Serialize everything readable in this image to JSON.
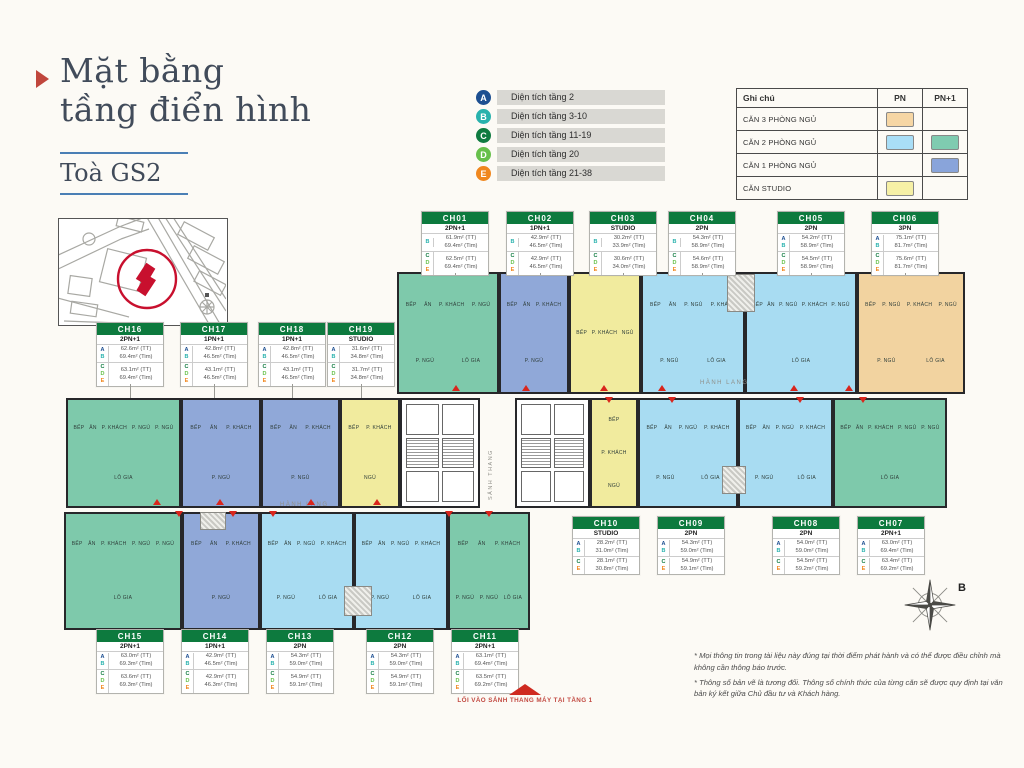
{
  "page": {
    "title_line1": "Mặt bằng",
    "title_line2": "tầng điển hình",
    "tower": "Toà GS2",
    "compass_letter": "B",
    "entry_label": "LỐI VÀO SẢNH THANG MÁY TẠI TẦNG 1"
  },
  "footnotes": [
    "* Mọi thông tin trong tài liệu này đúng tại thời điểm phát hành và có thể được điều chỉnh mà không cần thông báo trước.",
    "* Thông số bản vẽ là tương đối. Thông số chính thức của từng căn sẽ được quy định tại văn bản ký kết giữa Chủ đầu tư và Khách hàng."
  ],
  "legend_floors": [
    {
      "letter": "A",
      "color": "#1d4f91",
      "label": "Diện tích tầng 2"
    },
    {
      "letter": "B",
      "color": "#29b2ad",
      "label": "Diện tích tầng 3-10"
    },
    {
      "letter": "C",
      "color": "#0f7b40",
      "label": "Diện tích tầng 11-19"
    },
    {
      "letter": "D",
      "color": "#67c04b",
      "label": "Diện tích tầng 20"
    },
    {
      "letter": "E",
      "color": "#f0871e",
      "label": "Diện tích tầng 21-38"
    }
  ],
  "legend_table": {
    "header": [
      "Ghi chú",
      "PN",
      "PN+1"
    ],
    "rows": [
      {
        "label": "CĂN 3 PHÒNG NGỦ",
        "pn": "#f6d6a4",
        "pn1": null
      },
      {
        "label": "CĂN 2 PHÒNG NGỦ",
        "pn": "#a9def7",
        "pn1": "#7fcbb0"
      },
      {
        "label": "CĂN 1 PHÒNG NGỦ",
        "pn": null,
        "pn1": "#89a4da"
      },
      {
        "label": "CĂN STUDIO",
        "pn": "#f6f0a6",
        "pn1": null
      }
    ]
  },
  "letter_colors": {
    "A": "#1d4f91",
    "B": "#29b2ad",
    "C": "#0f7b40",
    "D": "#67c04b",
    "E": "#f0871e"
  },
  "type_colors": {
    "2PN+1": "#7ec9ab",
    "1PN+1": "#90a8d8",
    "STUDIO": "#f1eb9e",
    "2PN": "#a8dcf2",
    "3PN": "#f2d3a0"
  },
  "room_labels_by_type": {
    "STUDIO": [
      "BẾP",
      "P. KHÁCH",
      "NGỦ"
    ],
    "1PN+1": [
      "BẾP",
      "ĂN",
      "P. KHÁCH",
      "P. NGỦ"
    ],
    "2PN": [
      "BẾP",
      "ĂN",
      "P. NGỦ",
      "P. KHÁCH",
      "P. NGỦ",
      "LÔ GIA"
    ],
    "2PN+1": [
      "BẾP",
      "ĂN",
      "P. KHÁCH",
      "P. NGỦ",
      "P. NGỦ",
      "LÔ GIA"
    ],
    "3PN": [
      "BẾP",
      "P. NGỦ",
      "P. KHÁCH",
      "P. NGỦ",
      "P. NGỦ",
      "LÔ GIA"
    ]
  },
  "units": [
    {
      "id": "CH01",
      "type": "2PN+1",
      "card": {
        "row": "r1",
        "x": 421
      },
      "plan": {
        "wing": "top",
        "x": 397,
        "w": 102
      },
      "groups": [
        {
          "letters": [
            "B"
          ],
          "tt": "61.9m² (TT)",
          "tim": "69.4m² (Tim)"
        },
        {
          "letters": [
            "C",
            "D",
            "E"
          ],
          "tt": "62.5m² (TT)",
          "tim": "69.4m² (Tim)"
        }
      ]
    },
    {
      "id": "CH02",
      "type": "1PN+1",
      "card": {
        "row": "r1",
        "x": 506
      },
      "plan": {
        "wing": "top",
        "x": 499,
        "w": 70
      },
      "groups": [
        {
          "letters": [
            "B"
          ],
          "tt": "42.9m² (TT)",
          "tim": "46.5m² (Tim)"
        },
        {
          "letters": [
            "C",
            "D",
            "E"
          ],
          "tt": "42.9m² (TT)",
          "tim": "46.5m² (Tim)"
        }
      ]
    },
    {
      "id": "CH03",
      "type": "STUDIO",
      "card": {
        "row": "r1",
        "x": 589
      },
      "plan": {
        "wing": "top",
        "x": 569,
        "w": 72
      },
      "groups": [
        {
          "letters": [
            "B"
          ],
          "tt": "30.2m² (TT)",
          "tim": "33.9m² (Tim)"
        },
        {
          "letters": [
            "C",
            "D",
            "E"
          ],
          "tt": "30.6m² (TT)",
          "tim": "34.0m² (Tim)"
        }
      ]
    },
    {
      "id": "CH04",
      "type": "2PN",
      "card": {
        "row": "r1",
        "x": 668
      },
      "plan": {
        "wing": "top",
        "x": 641,
        "w": 104
      },
      "groups": [
        {
          "letters": [
            "B"
          ],
          "tt": "54.3m² (TT)",
          "tim": "58.9m² (Tim)"
        },
        {
          "letters": [
            "C",
            "D",
            "E"
          ],
          "tt": "54.6m² (TT)",
          "tim": "58.9m² (Tim)"
        }
      ]
    },
    {
      "id": "CH05",
      "type": "2PN",
      "card": {
        "row": "r1",
        "x": 777
      },
      "plan": {
        "wing": "top",
        "x": 745,
        "w": 112
      },
      "groups": [
        {
          "letters": [
            "A",
            "B"
          ],
          "tt": "54.2m² (TT)",
          "tim": "58.9m² (Tim)"
        },
        {
          "letters": [
            "C",
            "D",
            "E"
          ],
          "tt": "54.5m² (TT)",
          "tim": "58.9m² (Tim)"
        }
      ]
    },
    {
      "id": "CH06",
      "type": "3PN",
      "card": {
        "row": "r1",
        "x": 871
      },
      "plan": {
        "wing": "top",
        "x": 857,
        "w": 108
      },
      "groups": [
        {
          "letters": [
            "A",
            "B"
          ],
          "tt": "75.1m² (TT)",
          "tim": "81.7m² (Tim)"
        },
        {
          "letters": [
            "C",
            "D",
            "E"
          ],
          "tt": "75.6m² (TT)",
          "tim": "81.7m² (Tim)"
        }
      ]
    },
    {
      "id": "CH07",
      "type": "2PN+1",
      "card": {
        "row": "r3",
        "x": 857
      },
      "plan": {
        "wing": "mid",
        "x": 833,
        "w": 114
      },
      "groups": [
        {
          "letters": [
            "A",
            "B"
          ],
          "tt": "63.0m² (TT)",
          "tim": "69.4m² (Tim)"
        },
        {
          "letters": [
            "C",
            "E"
          ],
          "tt": "63.4m² (TT)",
          "tim": "69.2m² (Tim)"
        }
      ]
    },
    {
      "id": "CH08",
      "type": "2PN",
      "card": {
        "row": "r3",
        "x": 772
      },
      "plan": {
        "wing": "mid",
        "x": 738,
        "w": 95
      },
      "groups": [
        {
          "letters": [
            "A",
            "B"
          ],
          "tt": "54.0m² (TT)",
          "tim": "59.0m² (Tim)"
        },
        {
          "letters": [
            "C",
            "E"
          ],
          "tt": "54.5m² (TT)",
          "tim": "59.2m² (Tim)"
        }
      ]
    },
    {
      "id": "CH09",
      "type": "2PN",
      "card": {
        "row": "r3",
        "x": 657
      },
      "plan": {
        "wing": "mid",
        "x": 638,
        "w": 100
      },
      "groups": [
        {
          "letters": [
            "A",
            "B"
          ],
          "tt": "54.3m² (TT)",
          "tim": "59.0m² (Tim)"
        },
        {
          "letters": [
            "C",
            "E"
          ],
          "tt": "54.9m² (TT)",
          "tim": "59.1m² (Tim)"
        }
      ]
    },
    {
      "id": "CH10",
      "type": "STUDIO",
      "card": {
        "row": "r3",
        "x": 572
      },
      "plan": {
        "wing": "mid",
        "x": 590,
        "w": 48
      },
      "groups": [
        {
          "letters": [
            "A",
            "B"
          ],
          "tt": "28.2m² (TT)",
          "tim": "31.0m² (Tim)"
        },
        {
          "letters": [
            "C",
            "E"
          ],
          "tt": "28.1m² (TT)",
          "tim": "30.8m² (Tim)"
        }
      ]
    },
    {
      "id": "CH11",
      "type": "2PN+1",
      "card": {
        "row": "r4",
        "x": 451
      },
      "plan": {
        "wing": "bottom",
        "x": 448,
        "w": 82
      },
      "groups": [
        {
          "letters": [
            "A",
            "B"
          ],
          "tt": "63.1m² (TT)",
          "tim": "69.4m² (Tim)"
        },
        {
          "letters": [
            "C",
            "D",
            "E"
          ],
          "tt": "63.5m² (TT)",
          "tim": "69.2m² (Tim)"
        }
      ]
    },
    {
      "id": "CH12",
      "type": "2PN",
      "card": {
        "row": "r4",
        "x": 366
      },
      "plan": {
        "wing": "bottom",
        "x": 354,
        "w": 94
      },
      "groups": [
        {
          "letters": [
            "A",
            "B"
          ],
          "tt": "54.3m² (TT)",
          "tim": "59.0m² (Tim)"
        },
        {
          "letters": [
            "C",
            "D",
            "E"
          ],
          "tt": "54.9m² (TT)",
          "tim": "59.1m² (Tim)"
        }
      ]
    },
    {
      "id": "CH13",
      "type": "2PN",
      "card": {
        "row": "r4",
        "x": 266
      },
      "plan": {
        "wing": "bottom",
        "x": 260,
        "w": 94
      },
      "groups": [
        {
          "letters": [
            "A",
            "B"
          ],
          "tt": "54.3m² (TT)",
          "tim": "59.0m² (Tim)"
        },
        {
          "letters": [
            "C",
            "D",
            "E"
          ],
          "tt": "54.9m² (TT)",
          "tim": "59.1m² (Tim)"
        }
      ]
    },
    {
      "id": "CH14",
      "type": "1PN+1",
      "card": {
        "row": "r4",
        "x": 181
      },
      "plan": {
        "wing": "bottom",
        "x": 182,
        "w": 78
      },
      "groups": [
        {
          "letters": [
            "A",
            "B"
          ],
          "tt": "42.9m² (TT)",
          "tim": "46.5m² (Tim)"
        },
        {
          "letters": [
            "C",
            "D",
            "E"
          ],
          "tt": "42.9m² (TT)",
          "tim": "46.3m² (Tim)"
        }
      ]
    },
    {
      "id": "CH15",
      "type": "2PN+1",
      "card": {
        "row": "r4",
        "x": 96
      },
      "plan": {
        "wing": "bottom",
        "x": 64,
        "w": 118
      },
      "groups": [
        {
          "letters": [
            "A",
            "B"
          ],
          "tt": "63.0m² (TT)",
          "tim": "69.3m² (Tim)"
        },
        {
          "letters": [
            "C",
            "D",
            "E"
          ],
          "tt": "63.6m² (TT)",
          "tim": "69.3m² (Tim)"
        }
      ]
    },
    {
      "id": "CH16",
      "type": "2PN+1",
      "card": {
        "row": "r2",
        "x": 96
      },
      "plan": {
        "wing": "mid",
        "x": 66,
        "w": 115
      },
      "groups": [
        {
          "letters": [
            "A",
            "B"
          ],
          "tt": "62.6m² (TT)",
          "tim": "69.4m² (Tim)"
        },
        {
          "letters": [
            "C",
            "D",
            "E"
          ],
          "tt": "63.1m² (TT)",
          "tim": "69.4m² (Tim)"
        }
      ]
    },
    {
      "id": "CH17",
      "type": "1PN+1",
      "card": {
        "row": "r2",
        "x": 180
      },
      "plan": {
        "wing": "mid",
        "x": 181,
        "w": 80
      },
      "groups": [
        {
          "letters": [
            "A",
            "B"
          ],
          "tt": "42.8m² (TT)",
          "tim": "46.5m² (Tim)"
        },
        {
          "letters": [
            "C",
            "D",
            "E"
          ],
          "tt": "43.1m² (TT)",
          "tim": "46.5m² (Tim)"
        }
      ]
    },
    {
      "id": "CH18",
      "type": "1PN+1",
      "card": {
        "row": "r2",
        "x": 258
      },
      "plan": {
        "wing": "mid",
        "x": 261,
        "w": 79
      },
      "groups": [
        {
          "letters": [
            "A",
            "B"
          ],
          "tt": "42.8m² (TT)",
          "tim": "46.5m² (Tim)"
        },
        {
          "letters": [
            "C",
            "D",
            "E"
          ],
          "tt": "43.1m² (TT)",
          "tim": "46.5m² (Tim)"
        }
      ]
    },
    {
      "id": "CH19",
      "type": "STUDIO",
      "card": {
        "row": "r2",
        "x": 327
      },
      "plan": {
        "wing": "mid",
        "x": 340,
        "w": 60
      },
      "groups": [
        {
          "letters": [
            "A",
            "B"
          ],
          "tt": "31.6m² (TT)",
          "tim": "34.8m² (Tim)"
        },
        {
          "letters": [
            "C",
            "D",
            "E"
          ],
          "tt": "31.7m² (TT)",
          "tim": "34.8m² (Tim)"
        }
      ]
    }
  ],
  "plan": {
    "wings": {
      "top": {
        "y": 272,
        "h": 122
      },
      "mid": {
        "y": 398,
        "h": 110
      },
      "bottom": {
        "y": 512,
        "h": 118
      }
    },
    "card_rows": {
      "r1": {
        "y": 211,
        "tick_below": true
      },
      "r2": {
        "y": 322,
        "tick_below": true
      },
      "r3": {
        "y": 516,
        "tick_below": false
      },
      "r4": {
        "y": 629,
        "tick_below": false
      }
    },
    "cores": [
      {
        "x": 400,
        "y": 398,
        "w": 80,
        "h": 110
      },
      {
        "x": 515,
        "y": 398,
        "w": 75,
        "h": 110
      }
    ],
    "lobby_label": {
      "text": "SẢNH THANG",
      "x": 488,
      "y": 420,
      "h": 80
    },
    "corridors": [
      {
        "text": "HÀNH LANG",
        "x": 700,
        "y": 380
      },
      {
        "text": "HÀNH LANG",
        "x": 280,
        "y": 502
      }
    ],
    "hatches": [
      {
        "x": 727,
        "y": 274,
        "w": 28,
        "h": 38
      },
      {
        "x": 722,
        "y": 466,
        "w": 24,
        "h": 28
      },
      {
        "x": 344,
        "y": 586,
        "w": 28,
        "h": 30
      },
      {
        "x": 200,
        "y": 512,
        "w": 26,
        "h": 18
      }
    ],
    "arrows": [
      {
        "dir": "up",
        "y": 385,
        "xs": [
          452,
          522,
          600,
          658,
          790,
          845
        ]
      },
      {
        "dir": "down",
        "y": 397,
        "xs": [
          605,
          668,
          796,
          859
        ]
      },
      {
        "dir": "up",
        "y": 499,
        "xs": [
          153,
          216,
          307,
          373
        ]
      },
      {
        "dir": "down",
        "y": 511,
        "xs": [
          175,
          229,
          269,
          445,
          485
        ]
      }
    ]
  }
}
